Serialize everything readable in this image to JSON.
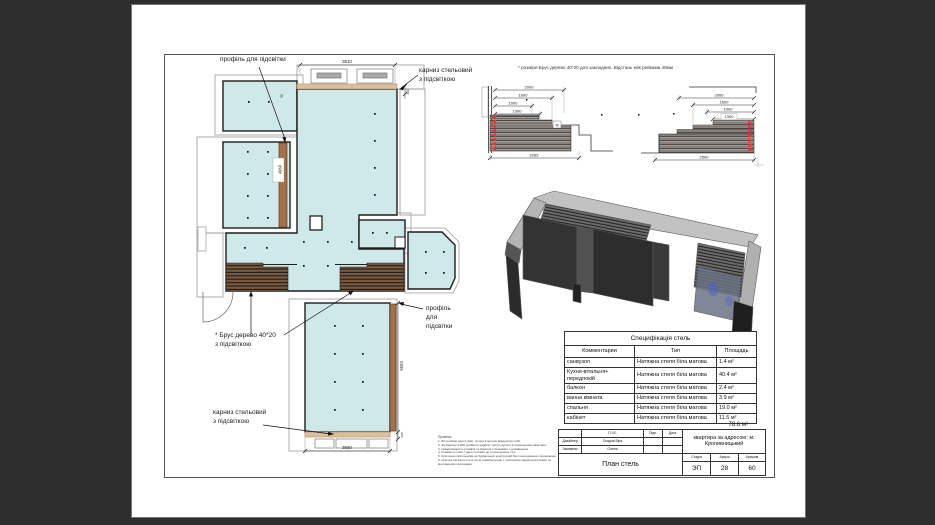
{
  "plan": {
    "labels": {
      "profile_top": "профіль для підсвітки",
      "cornice_top": [
        "карниз стельовий",
        "з підсвіткою"
      ],
      "brus": [
        "* Брус дерево 40*20",
        "з підсвіткою"
      ],
      "profile_right": [
        "профіль",
        "для",
        "підсвітки"
      ],
      "cornice_bottom": [
        "карниз стельовий",
        "з підсвіткою"
      ]
    },
    "dims": {
      "top": "3810",
      "gap": "50",
      "left_room": "4960",
      "cornice_top": "200",
      "lower_right": "5503",
      "bottom": "3560",
      "cornice_bottom": "200"
    }
  },
  "details": {
    "note": "* розміри Брус дерево 40*20 для закладних. Відстань між рейками 40мм",
    "left": {
      "dims": [
        "2000",
        "1600",
        "1000",
        "1300"
      ],
      "bottom": "2265",
      "gap": "40"
    },
    "right": {
      "dims": [
        "2000",
        "1600",
        "1000",
        "1300"
      ],
      "bottom": "2500"
    }
  },
  "spec": {
    "title": "Специфікація стель",
    "headers": [
      "Комментарии",
      "Тип",
      "Площадь"
    ],
    "rows": [
      [
        "санвузол",
        "Натяжна стеля біла матова",
        "1.4 м²"
      ],
      [
        "Кухня-вітальня+ передпокій",
        "Натяжна стеля біла матова",
        "40.4 м²"
      ],
      [
        "балкон",
        "Натяжна стеля біла матова",
        "2.4 м²"
      ],
      [
        "ванна кімната",
        "Натяжна стеля біла матова",
        "3.9 м²"
      ],
      [
        "спальня",
        "Натяжна стеля біла матова",
        "19.0 м²"
      ],
      [
        "кабінет",
        "Натяжна стеля біла матова",
        "11.5 м²"
      ]
    ],
    "total": "78.6 м²"
  },
  "tb": {
    "pib": "П.І.Б.",
    "sign": "Підп.",
    "date": "Дата",
    "designer_label": "Дизайнер",
    "designer_name": "Осадча Віра",
    "client_label": "Замовник",
    "client_name": "Олена",
    "doc_title": "План стель",
    "address_l1": "квартира за адресою: м.",
    "address_l2": "Кропивницький",
    "stage_label": "Стадія",
    "sheet_label": "Аркуш",
    "sheets_label": "Аркушів",
    "stage": "ЭП",
    "sheet": "28",
    "sheets": "60"
  },
  "notes": {
    "title": "Примітки",
    "lines": [
      "1. Всі розміри дані в (мм), площа в метрах квадратних (м2).",
      "2. За відмітку 0.000 прийнято відмітку чистої підлоги в приміщеннях квартири.",
      "3. Невідповідність розмірів та відміток уточнювати з дизайнером.",
      "4. Розміри в плані * дані стосовно до штукатурених стін.",
      "5. Кріплення світильників до будівельних конструкцій без пошкодження опорядження.",
      "6. Монтаж натяжної стелі після ознайомлення з технічними характеристиками та",
      "монтажними приладами."
    ]
  }
}
